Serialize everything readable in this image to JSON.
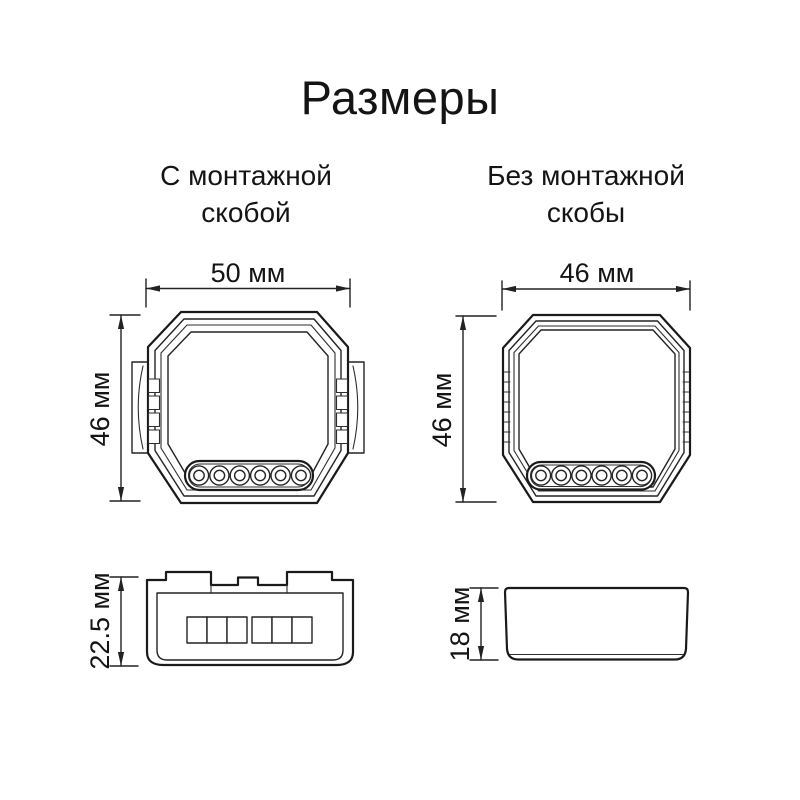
{
  "title": "Размеры",
  "views": {
    "with_bracket": {
      "caption": [
        "С монтажной",
        "скобой"
      ],
      "front": {
        "width": "50 мм",
        "height": "46 мм"
      },
      "side": {
        "depth": "22.5 мм"
      }
    },
    "without_bracket": {
      "caption": [
        "Без монтажной",
        "скобы"
      ],
      "front": {
        "width": "46 мм",
        "height": "46 мм"
      },
      "side": {
        "depth": "18 мм"
      }
    }
  }
}
